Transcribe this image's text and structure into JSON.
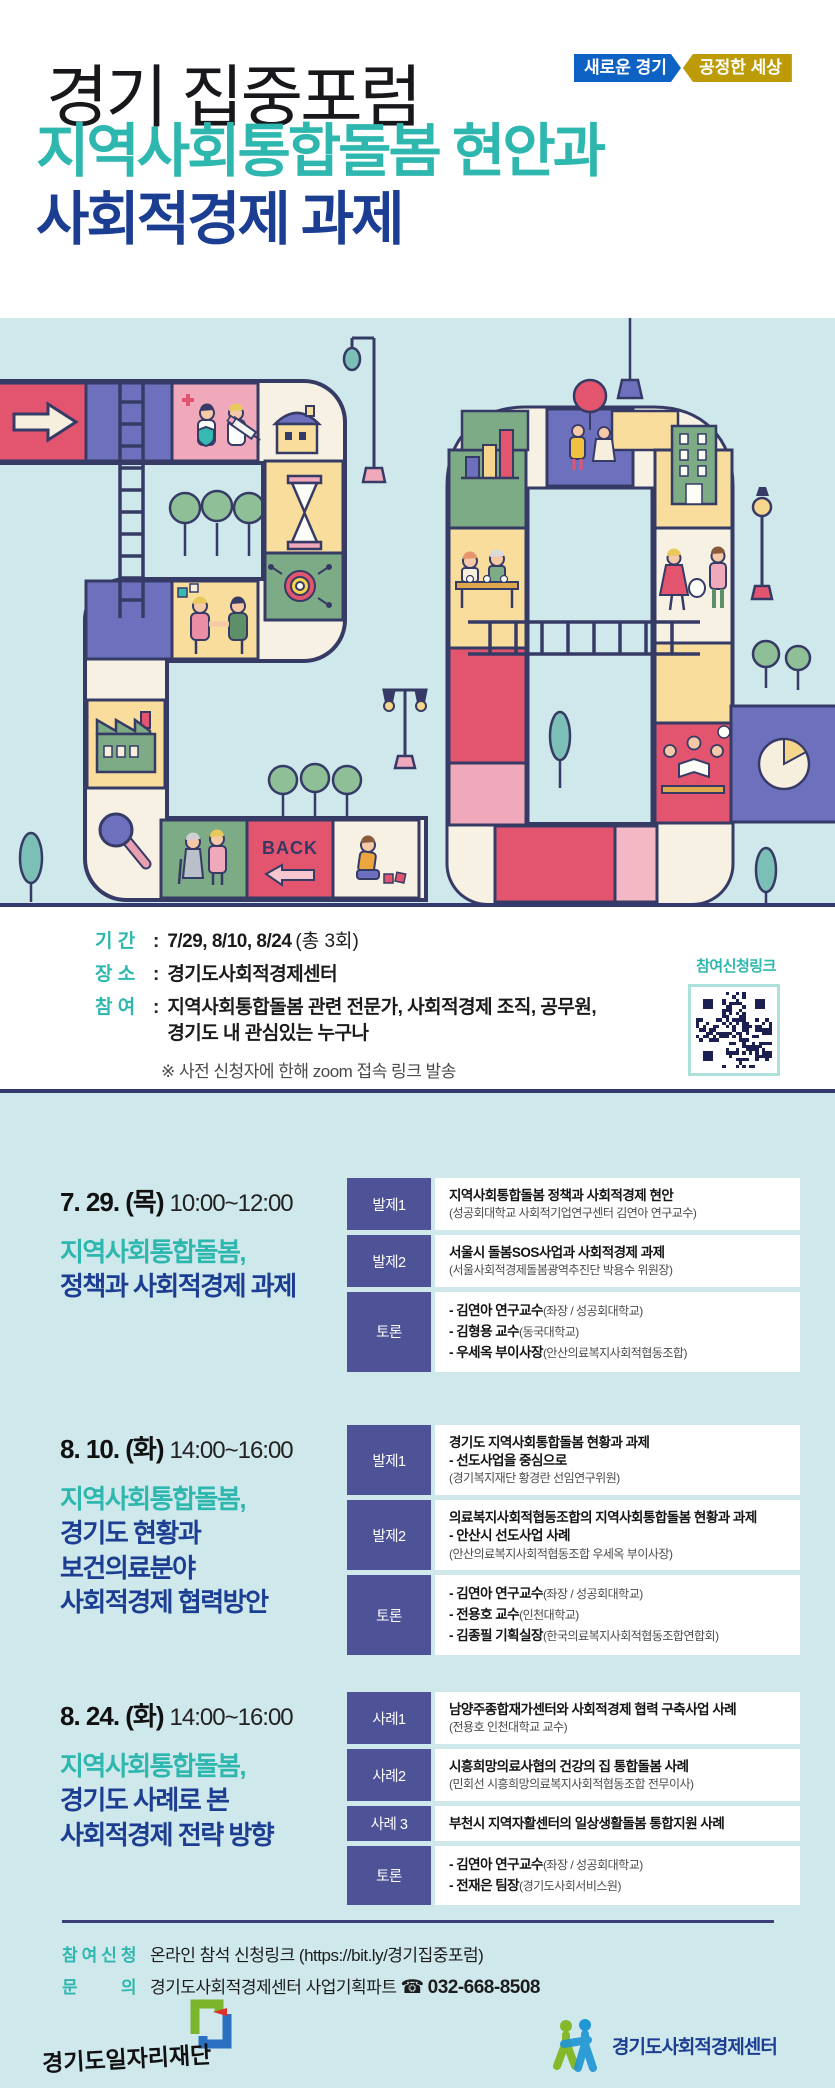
{
  "colors": {
    "teal": "#2eb7ae",
    "navy": "#1c3e92",
    "badge_blue": "#0e62c4",
    "badge_gold": "#bd9b06",
    "label_bg": "#4e5296",
    "section_bg": "#cfe8eb",
    "border_line": "#343a6e",
    "qr_ink": "#1b2050"
  },
  "header": {
    "forum_label": "경기 집중포럼",
    "badge_blue": "새로운 경기",
    "badge_gold": "공정한 세상",
    "title_line1": "지역사회통합돌봄 현안과",
    "title_line2": "사회적경제 과제"
  },
  "illustration": {
    "back_label": "BACK"
  },
  "info": {
    "rows": [
      {
        "label": "기 간",
        "strong": "7/29, 8/10, 8/24",
        "normal": "(총 3회)"
      },
      {
        "label": "장 소",
        "strong": "경기도사회적경제센터",
        "normal": ""
      },
      {
        "label": "참 여",
        "strong": "지역사회통합돌봄 관련 전문가, 사회적경제 조직, 공무원,",
        "normal": "",
        "line2": "경기도 내 관심있는 누구나"
      }
    ],
    "note": "※ 사전 신청자에 한해 zoom 접속 링크 발송",
    "qr_label": "참여신청링크"
  },
  "sessions": [
    {
      "date": "7. 29. (목)",
      "time": "10:00~12:00",
      "subtitle_teal": "지역사회통합돌봄,",
      "subtitle_navy": [
        "정책과 사회적경제 과제"
      ],
      "rows": [
        {
          "label": "발제1",
          "titles": [
            "지역사회통합돌봄 정책과 사회적경제 현안"
          ],
          "paren": "(성공회대학교 사회적기업연구센터 김연아 연구교수)"
        },
        {
          "label": "발제2",
          "titles": [
            "서울시 돌봄SOS사업과 사회적경제 과제"
          ],
          "paren": "(서울사회적경제돌봄광역추진단 박용수 위원장)"
        },
        {
          "label": "토론",
          "debate": [
            {
              "bold": "- 김연아 연구교수",
              "paren": "(좌장 / 성공회대학교)"
            },
            {
              "bold": "- 김형용 교수",
              "paren": "(동국대학교)"
            },
            {
              "bold": "- 우세옥 부이사장",
              "paren": "(안산의료복지사회적협동조합)"
            }
          ]
        }
      ]
    },
    {
      "date": "8. 10. (화)",
      "time": "14:00~16:00",
      "subtitle_teal": "지역사회통합돌봄,",
      "subtitle_navy": [
        "경기도 현황과",
        "보건의료분야",
        "사회적경제 협력방안"
      ],
      "rows": [
        {
          "label": "발제1",
          "titles": [
            "경기도 지역사회통합돌봄 현황과 과제",
            "- 선도사업을 중심으로"
          ],
          "paren": "(경기복지재단 황경란 선임연구위원)"
        },
        {
          "label": "발제2",
          "titles": [
            "의료복지사회적협동조합의 지역사회통합돌봄 현황과 과제",
            "- 안산시 선도사업 사례"
          ],
          "paren": "(안산의료복지사회적협동조합 우세옥 부이사장)"
        },
        {
          "label": "토론",
          "debate": [
            {
              "bold": "- 김연아 연구교수",
              "paren": "(좌장 / 성공회대학교)"
            },
            {
              "bold": "- 전용호 교수",
              "paren": "(인천대학교)"
            },
            {
              "bold": "- 김종필 기획실장",
              "paren": "(한국의료복지사회적협동조합연합회)"
            }
          ]
        }
      ]
    },
    {
      "date": "8. 24. (화)",
      "time": "14:00~16:00",
      "subtitle_teal": "지역사회통합돌봄,",
      "subtitle_navy": [
        "경기도 사례로 본",
        "사회적경제 전략 방향"
      ],
      "rows": [
        {
          "label": "사례1",
          "titles": [
            "남양주종합재가센터와 사회적경제 협력 구축사업 사례"
          ],
          "paren": "(전용호 인천대학교 교수)"
        },
        {
          "label": "사례2",
          "titles": [
            "시흥희망의료사협의 건강의 집 통합돌봄 사례"
          ],
          "paren": "(민회선 시흥희망의료복지사회적협동조합 전무이사)"
        },
        {
          "label": "사례 3",
          "titles": [
            "부천시 지역자활센터의 일상생활돌봄 통합지원 사례"
          ]
        },
        {
          "label": "토론",
          "debate": [
            {
              "bold": "- 김연아 연구교수",
              "paren": "(좌장 / 성공회대학교)"
            },
            {
              "bold": "- 전재은 팀장",
              "paren": "(경기도사회서비스원)"
            }
          ]
        }
      ]
    }
  ],
  "footer": {
    "apply_label": "참여신청",
    "apply_text": "온라인 참석 신청링크 (https://bit.ly/경기집중포럼)",
    "contact_label": "문의",
    "contact_text": "경기도사회적경제센터 사업기획파트",
    "phone_icon": "☎",
    "phone": "032-668-8508",
    "logo_left_text": "경기도일자리재단",
    "logo_right_text": "경기도사회적경제센터"
  }
}
